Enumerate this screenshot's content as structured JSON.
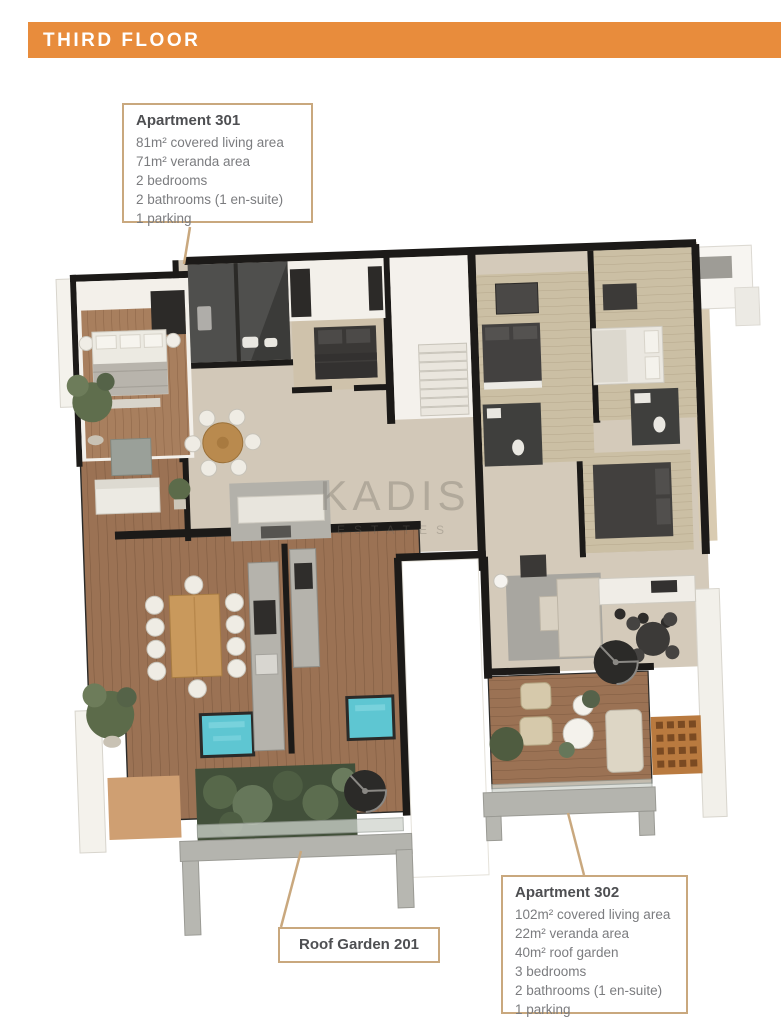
{
  "header": {
    "title": "THIRD FLOOR",
    "background_color": "#E88C3C",
    "text_color": "#FFFFFF"
  },
  "watermark": {
    "line1": "KADIS",
    "line2": "ESTATES"
  },
  "callouts": {
    "apartment_301": {
      "title": "Apartment 301",
      "lines": [
        "81m² covered living area",
        "71m² veranda area",
        "2 bedrooms",
        "2 bathrooms (1 en-suite)",
        "1 parking"
      ]
    },
    "apartment_302": {
      "title": "Apartment 302",
      "lines": [
        "102m² covered living area",
        "22m² veranda area",
        "40m² roof garden",
        "3 bedrooms",
        "2 bathrooms (1 en-suite)",
        "1 parking"
      ]
    },
    "roof_garden": {
      "label": "Roof Garden 201"
    }
  },
  "colors": {
    "callout_border": "#C9A87E",
    "leader_line": "#C9A87E",
    "title_text": "#4E4F52",
    "body_text": "#7B7C7F",
    "wall": "#1C1A18",
    "floor_beige": "#D2C8B8",
    "deck_wood": "#9B7254",
    "bedroom_wood": "#A87F5E",
    "pool_water": "#5EC6D2",
    "greenery": "#57684A",
    "concrete_frame": "#B4B4AE",
    "pergola_brick": "#B97A3F"
  }
}
